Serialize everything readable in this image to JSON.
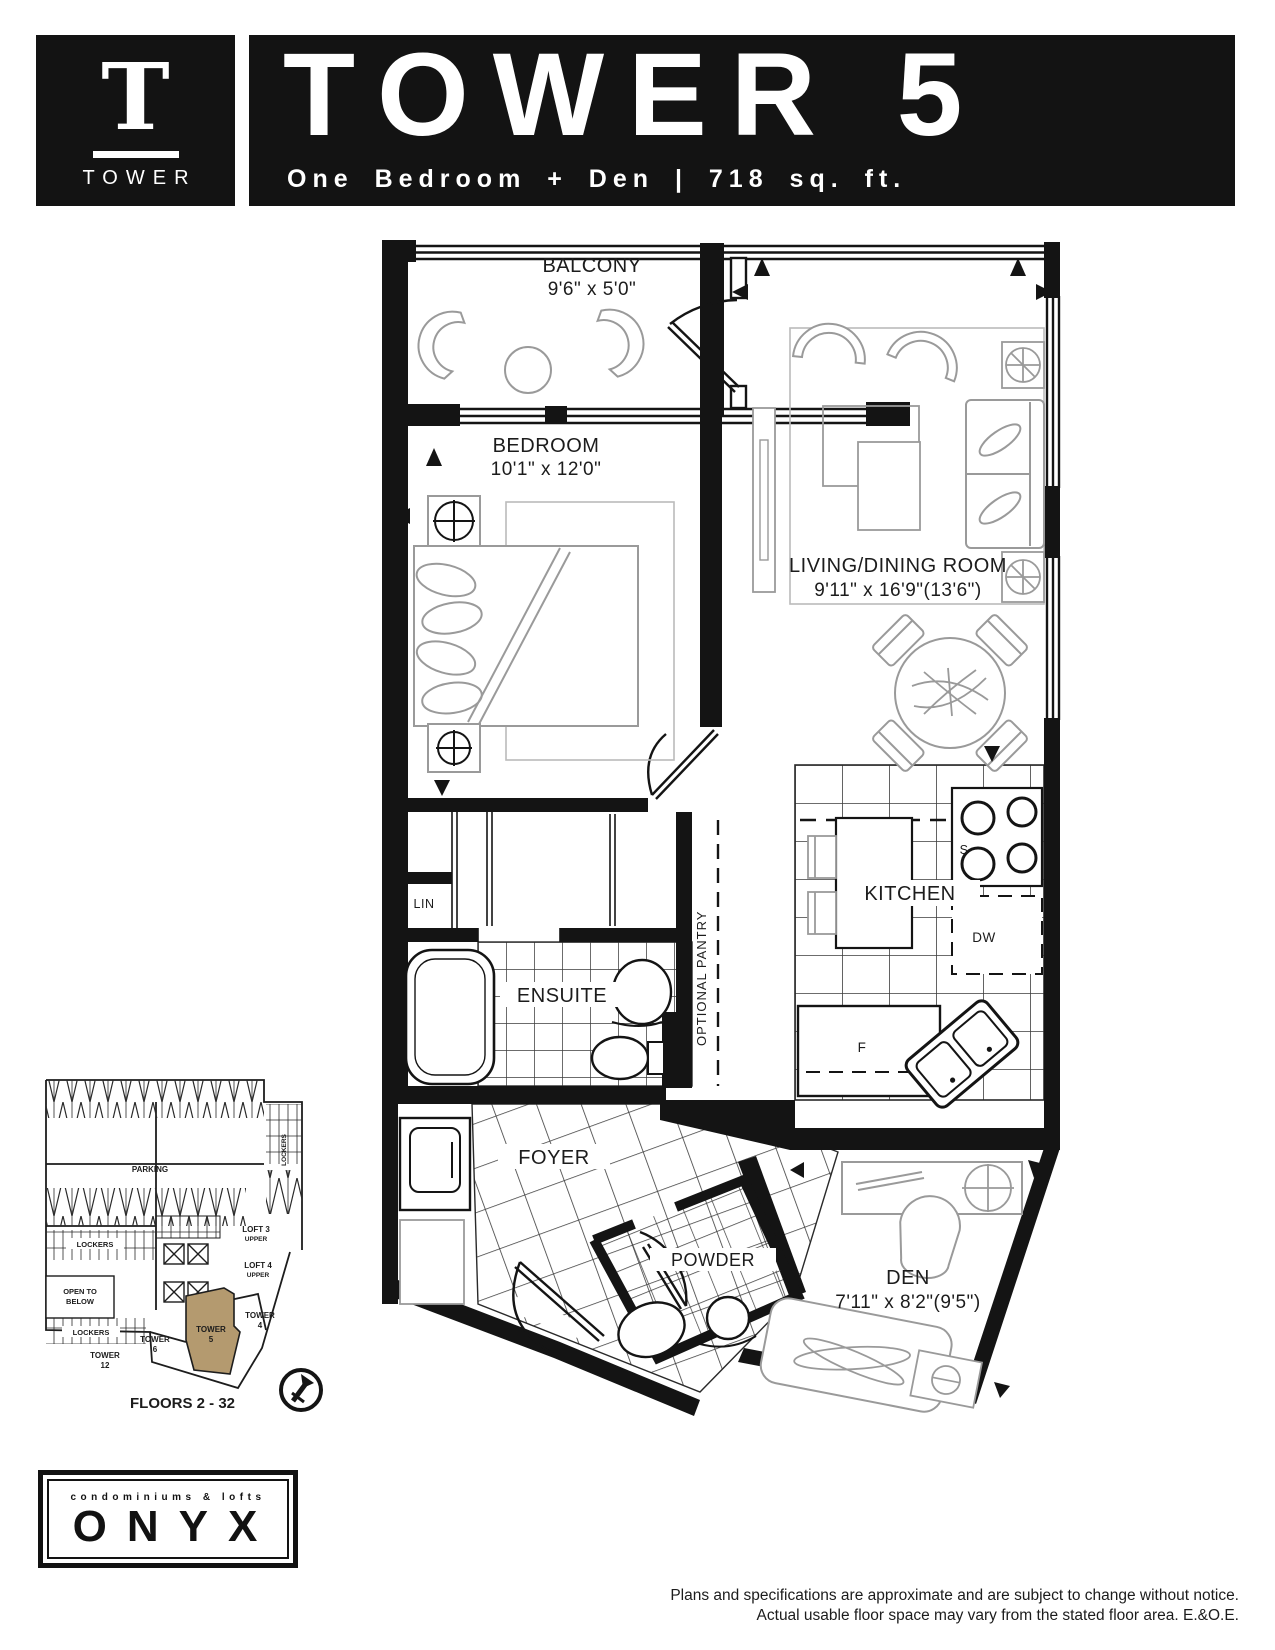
{
  "header": {
    "badge_letter": "T",
    "badge_word": "TOWER",
    "title": "TOWER 5",
    "subtitle": "One Bedroom + Den  |  718 sq. ft."
  },
  "plan": {
    "rooms": {
      "balcony": {
        "label": "BALCONY",
        "dims": "9'6\" x 5'0\""
      },
      "bedroom": {
        "label": "BEDROOM",
        "dims": "10'1\" x 12'0\""
      },
      "living_dining": {
        "label": "LIVING/DINING ROOM",
        "dims": "9'11\" x 16'9\"(13'6\")"
      },
      "kitchen": {
        "label": "KITCHEN"
      },
      "ensuite": {
        "label": "ENSUITE"
      },
      "linen": {
        "label": "LIN"
      },
      "pantry": {
        "label": "OPTIONAL PANTRY"
      },
      "foyer": {
        "label": "FOYER"
      },
      "powder": {
        "label": "POWDER"
      },
      "den": {
        "label": "DEN",
        "dims": "7'11\" x 8'2\"(9'5\")"
      }
    },
    "appliances": {
      "stove": "S",
      "dishwasher": "DW",
      "fridge": "F"
    }
  },
  "keyplan": {
    "parking_label": "PARKING",
    "lockers_label": "LOCKERS",
    "open_to_below_line1": "OPEN TO",
    "open_to_below_line2": "BELOW",
    "loft3_line1": "LOFT 3",
    "loft3_line2": "UPPER",
    "loft4_line1": "LOFT 4",
    "loft4_line2": "UPPER",
    "tower_word": "TOWER",
    "tower4_num": "4",
    "tower5_num": "5",
    "tower6_num": "6",
    "tower12_num": "12",
    "floors_label": "FLOORS 2 - 32",
    "highlight_color": "#b49a6f"
  },
  "logo": {
    "tagline": "condominiums & lofts",
    "name": "ONYX"
  },
  "footer": {
    "line1": "Plans and specifications are approximate and are subject to change without notice.",
    "line2": "Actual usable floor space may vary from the stated floor area. E.&O.E."
  }
}
